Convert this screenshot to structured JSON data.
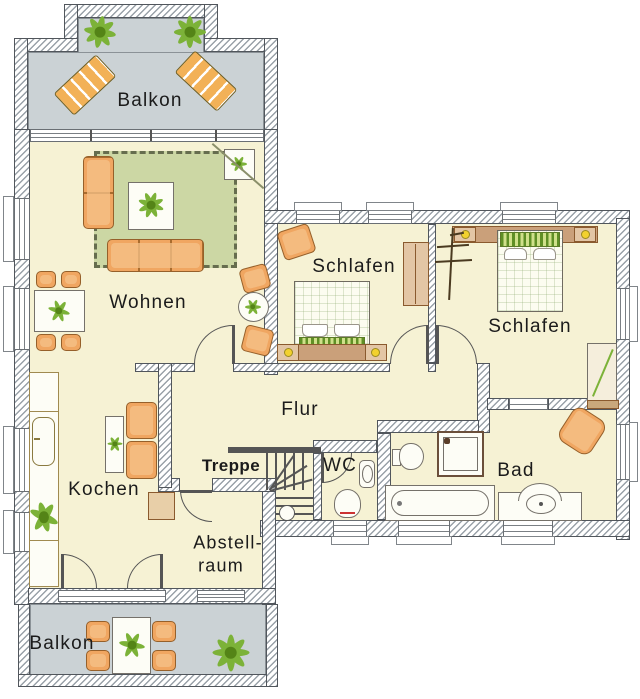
{
  "labels": {
    "balkon_top": "Balkon",
    "wohnen": "Wohnen",
    "schlafen_left": "Schlafen",
    "schlafen_right": "Schlafen",
    "flur": "Flur",
    "treppe": "Treppe",
    "wc": "WC",
    "bad": "Bad",
    "kochen": "Kochen",
    "abstell_line1": "Abstell-",
    "abstell_line2": "raum",
    "balkon_bottom": "Balkon"
  },
  "colors": {
    "room_floor": "#f6f2d4",
    "balcony_floor": "#cbd2d5",
    "wall_outline": "#51565c",
    "furniture_orange": "#f0a661",
    "rug_green": "#ccd7a4",
    "plant_green": "#7cb238",
    "wood_tan": "#dfb98e",
    "lamp_yellow": "#f2d12e",
    "toilet_seat_red": "#cc3333"
  }
}
